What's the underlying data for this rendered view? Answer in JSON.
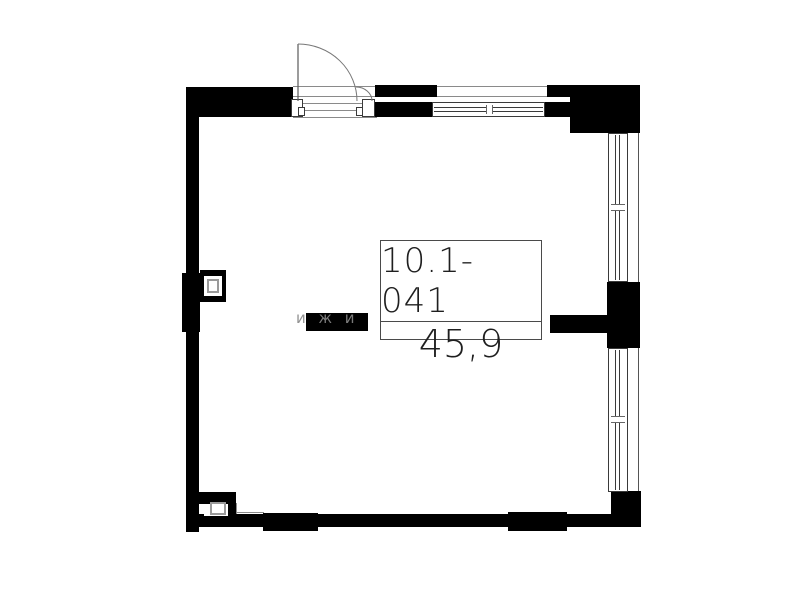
{
  "plan": {
    "unit_number": "10.1-041",
    "area_value": "45,9",
    "watermark_text": "и ж и",
    "colors": {
      "wall": "#000000",
      "thin_line": "#8a8a8a",
      "label_text": "#1f1f1f",
      "background": "#ffffff"
    }
  }
}
